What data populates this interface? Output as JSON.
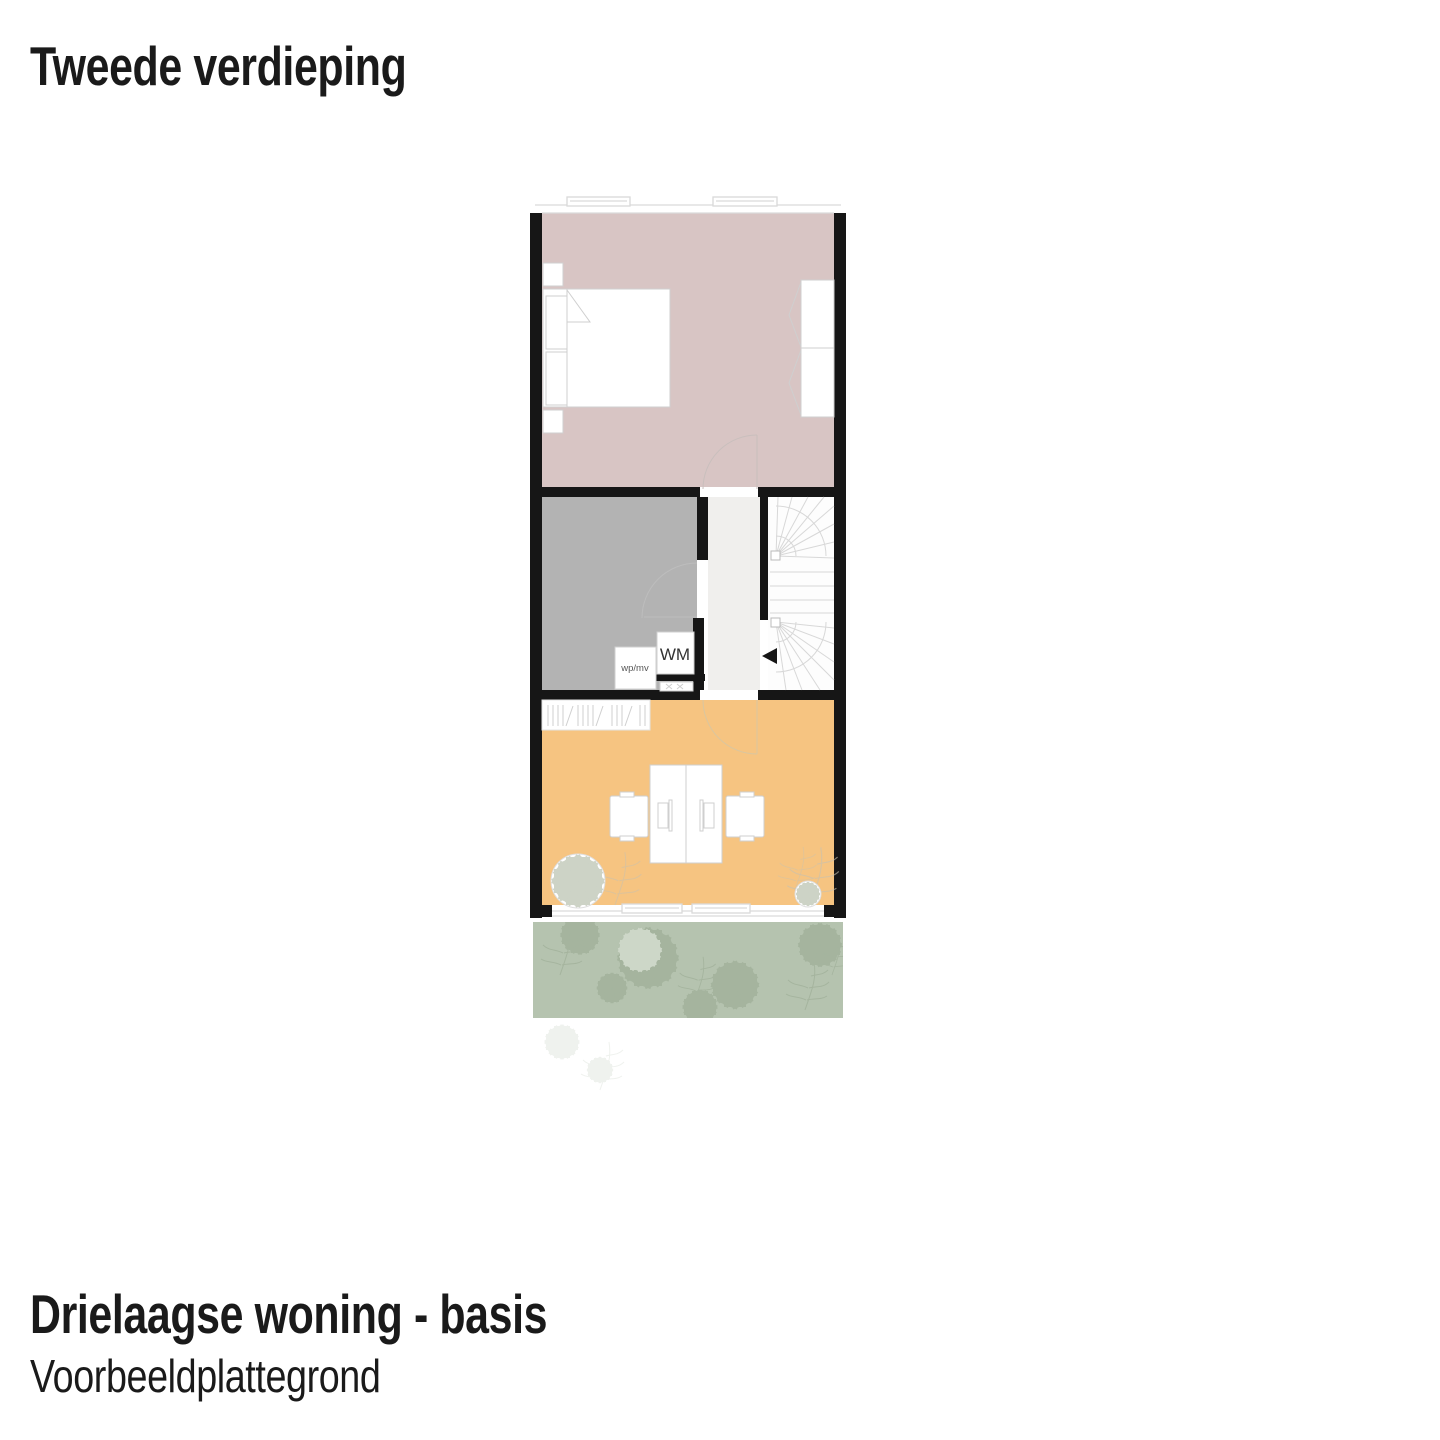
{
  "header": {
    "title": "Tweede verdieping"
  },
  "footer": {
    "title": "Drielaagse woning - basis",
    "subtitle": "Voorbeeldplattegrond"
  },
  "plan": {
    "labels": {
      "washing_machine": "WM",
      "wpmv": "wp/mv"
    },
    "colors": {
      "wall": "#161616",
      "bedroom_fill": "#d8c5c4",
      "bathroom_fill": "#b3b3b3",
      "office_fill": "#f6c481",
      "terrace_fill": "#b5c3af",
      "hallway_fill": "#f0efed",
      "stair_fill": "#fdfdfd",
      "furniture_line": "#cfcfcf",
      "stair_line": "#d8d8d8",
      "glass_line": "#d9d9d9",
      "foliage_line": "#96a78f",
      "accent_foliage": "#c8c2b0",
      "text": "#1a1a1a",
      "label_text": "#333333"
    }
  }
}
